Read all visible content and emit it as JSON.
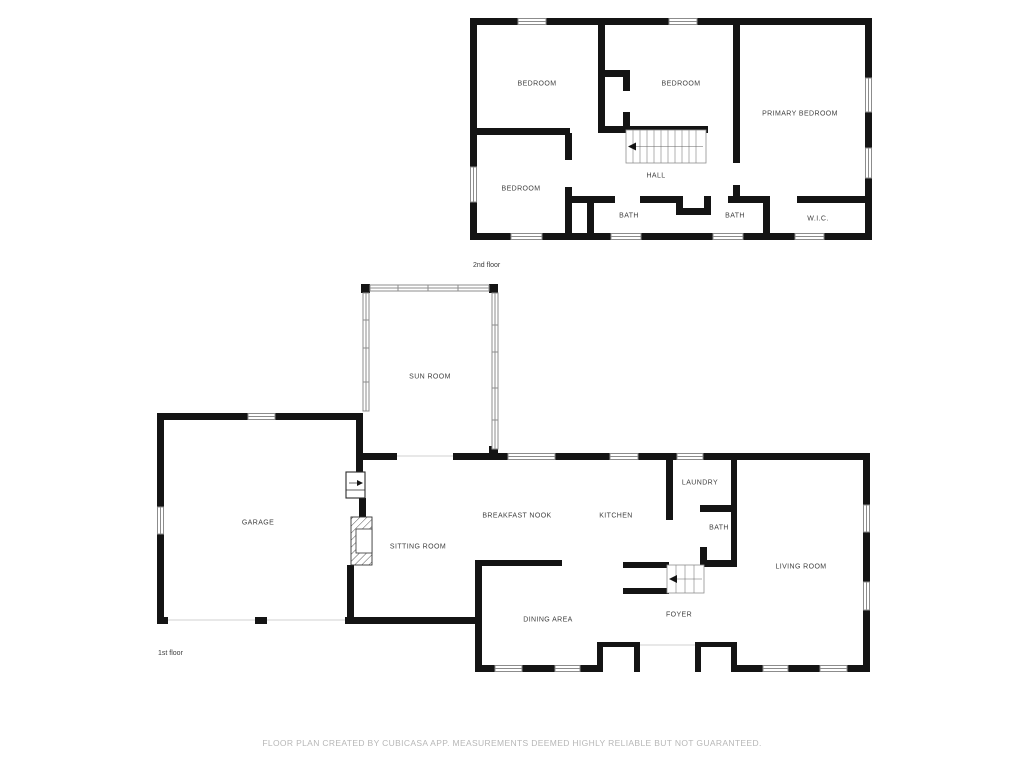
{
  "floor2": {
    "caption": "2nd floor",
    "rooms": [
      {
        "label": "BEDROOM"
      },
      {
        "label": "BEDROOM"
      },
      {
        "label": "PRIMARY BEDROOM"
      },
      {
        "label": "BEDROOM"
      },
      {
        "label": "HALL"
      },
      {
        "label": "BATH"
      },
      {
        "label": "BATH"
      },
      {
        "label": "W.I.C."
      }
    ]
  },
  "floor1": {
    "caption": "1st floor",
    "rooms": [
      {
        "label": "SUN ROOM"
      },
      {
        "label": "GARAGE"
      },
      {
        "label": "SITTING ROOM"
      },
      {
        "label": "BREAKFAST NOOK"
      },
      {
        "label": "KITCHEN"
      },
      {
        "label": "LAUNDRY"
      },
      {
        "label": "BATH"
      },
      {
        "label": "LIVING ROOM"
      },
      {
        "label": "DINING AREA"
      },
      {
        "label": "FOYER"
      }
    ]
  },
  "footer": {
    "disclaimer": "FLOOR PLAN CREATED BY CUBICASA APP. MEASUREMENTS DEEMED HIGHLY RELIABLE BUT NOT GUARANTEED."
  },
  "colors": {
    "wall": "#141414",
    "window_stroke": "#8c8c8c",
    "opening_line": "#d0d0d0",
    "label_text": "#3f3f3f",
    "footer_text": "#b7b7b7",
    "background": "#ffffff"
  }
}
